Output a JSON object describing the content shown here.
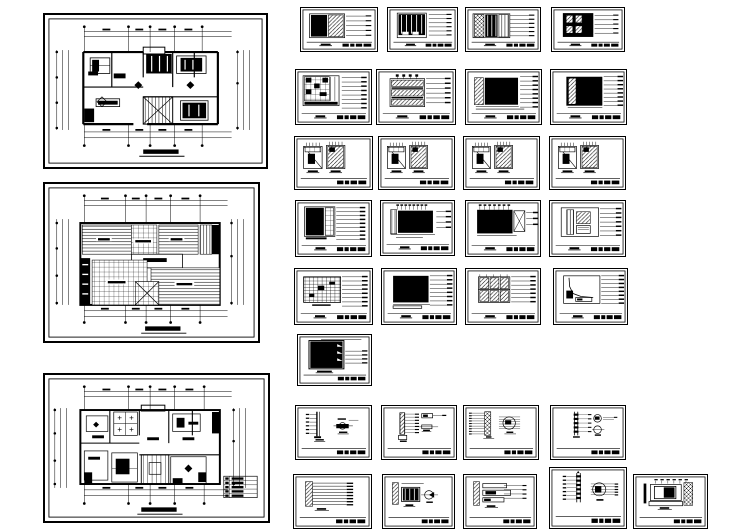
{
  "document": {
    "type": "cad-drawing-set",
    "description": "Architectural interior design CAD drawing set: three residential floor and ceiling plans with dimension grids on the left, and thirty small elevation, section and joinery detail sheets arranged in a grid on the right. Black line work on white paper; all annotation text is at illegible micro scale.",
    "paper_color": "#ffffff",
    "ink_color": "#000000",
    "sheet_count_total": 33
  },
  "plan_sheets": [
    {
      "id": "plan-upper-floor",
      "kind": "furniture layout floor plan with dimension chains and title mark",
      "variant": "plan1",
      "x": 43,
      "y": 13,
      "w": 225,
      "h": 156,
      "has_title_mark": true,
      "has_legend": false
    },
    {
      "id": "ceiling-plan",
      "kind": "reflected ceiling plan with hatched panels, tile grids and title mark",
      "variant": "ceiling",
      "x": 43,
      "y": 182,
      "w": 217,
      "h": 161,
      "has_title_mark": true,
      "has_legend": false
    },
    {
      "id": "plan-lower-floor",
      "kind": "floor plan with legend table and title mark",
      "variant": "plan2",
      "x": 43,
      "y": 373,
      "w": 227,
      "h": 150,
      "has_title_mark": true,
      "has_legend": true
    }
  ],
  "detail_sheets": [
    {
      "id": "detail-01",
      "kind": "wall elevation, dark panel + diagonal hatch",
      "variant": "r1a",
      "x": 300,
      "y": 7,
      "w": 78,
      "h": 45
    },
    {
      "id": "detail-02",
      "kind": "wall elevation, dark panel with mullions",
      "variant": "r1b",
      "x": 387,
      "y": 7,
      "w": 71,
      "h": 45
    },
    {
      "id": "detail-03",
      "kind": "wall elevation, mixed hatch panels",
      "variant": "r1c",
      "x": 465,
      "y": 7,
      "w": 76,
      "h": 45
    },
    {
      "id": "detail-04",
      "kind": "dark elevation with hatched insets",
      "variant": "r1d",
      "x": 551,
      "y": 7,
      "w": 74,
      "h": 45
    },
    {
      "id": "detail-05",
      "kind": "cabinet elevation with grid cells",
      "variant": "r2a",
      "x": 295,
      "y": 69,
      "w": 77,
      "h": 56
    },
    {
      "id": "detail-06",
      "kind": "elevation with three hatched bands",
      "variant": "r2b",
      "x": 376,
      "y": 69,
      "w": 80,
      "h": 56
    },
    {
      "id": "detail-07",
      "kind": "large dark elevation, hatched side strip",
      "variant": "r2c",
      "x": 465,
      "y": 69,
      "w": 77,
      "h": 56
    },
    {
      "id": "detail-08",
      "kind": "large dark elevation, inner hatched strip",
      "variant": "r2d",
      "x": 550,
      "y": 69,
      "w": 77,
      "h": 56
    },
    {
      "id": "detail-09",
      "kind": "pair of wardrobe elevations",
      "variant": "r3",
      "x": 294,
      "y": 136,
      "w": 79,
      "h": 54
    },
    {
      "id": "detail-10",
      "kind": "pair of wardrobe elevations",
      "variant": "r3",
      "x": 378,
      "y": 136,
      "w": 77,
      "h": 54
    },
    {
      "id": "detail-11",
      "kind": "pair of wardrobe elevations",
      "variant": "r3",
      "x": 463,
      "y": 136,
      "w": 77,
      "h": 54
    },
    {
      "id": "detail-12",
      "kind": "pair of wardrobe elevations",
      "variant": "r3",
      "x": 549,
      "y": 136,
      "w": 77,
      "h": 54
    },
    {
      "id": "detail-13",
      "kind": "cabinet elevation with leader stack",
      "variant": "r4a",
      "x": 295,
      "y": 200,
      "w": 77,
      "h": 57
    },
    {
      "id": "detail-14",
      "kind": "wide elevation with top callout flags",
      "variant": "r4b",
      "x": 380,
      "y": 200,
      "w": 75,
      "h": 56
    },
    {
      "id": "detail-15",
      "kind": "wide dark elevation with X-braced panel",
      "variant": "r4c",
      "x": 465,
      "y": 200,
      "w": 76,
      "h": 57
    },
    {
      "id": "detail-16",
      "kind": "elevation with vertical and diagonal hatch",
      "variant": "r4d",
      "x": 549,
      "y": 200,
      "w": 77,
      "h": 57
    },
    {
      "id": "detail-17",
      "kind": "gridded screen elevation",
      "variant": "r5a",
      "x": 294,
      "y": 268,
      "w": 79,
      "h": 57
    },
    {
      "id": "detail-18",
      "kind": "solid dark elevation",
      "variant": "r5b",
      "x": 381,
      "y": 268,
      "w": 76,
      "h": 57
    },
    {
      "id": "detail-19",
      "kind": "elevation with six hatched door cells",
      "variant": "r5c",
      "x": 465,
      "y": 268,
      "w": 76,
      "h": 57
    },
    {
      "id": "detail-20",
      "kind": "elevation with curved profile",
      "variant": "r5d",
      "x": 553,
      "y": 268,
      "w": 75,
      "h": 57
    },
    {
      "id": "detail-21",
      "kind": "single dark elevation with notches",
      "variant": "r6",
      "x": 297,
      "y": 334,
      "w": 75,
      "h": 52
    },
    {
      "id": "detail-22",
      "kind": "vertical section + capsule detail",
      "variant": "r7a",
      "x": 295,
      "y": 405,
      "w": 77,
      "h": 55
    },
    {
      "id": "detail-23",
      "kind": "vertical section + two small details",
      "variant": "r7b",
      "x": 381,
      "y": 405,
      "w": 76,
      "h": 55
    },
    {
      "id": "detail-24",
      "kind": "hatched section + circled detail",
      "variant": "r7c",
      "x": 463,
      "y": 405,
      "w": 76,
      "h": 55
    },
    {
      "id": "detail-25",
      "kind": "section + two circled details",
      "variant": "r7d",
      "x": 550,
      "y": 405,
      "w": 76,
      "h": 55
    },
    {
      "id": "detail-26",
      "kind": "hatched jamb section with leaders",
      "variant": "r8a",
      "x": 293,
      "y": 474,
      "w": 79,
      "h": 55
    },
    {
      "id": "detail-27",
      "kind": "section + circle detail with dark sector",
      "variant": "r8b",
      "x": 382,
      "y": 474,
      "w": 73,
      "h": 55
    },
    {
      "id": "detail-28",
      "kind": "stacked profile sections",
      "variant": "r8c",
      "x": 463,
      "y": 474,
      "w": 74,
      "h": 55
    },
    {
      "id": "detail-29",
      "kind": "tall section + large circled detail",
      "variant": "r8d",
      "x": 549,
      "y": 467,
      "w": 78,
      "h": 62
    },
    {
      "id": "detail-30",
      "kind": "plan detail with nested frames and hatch",
      "variant": "r8e",
      "x": 633,
      "y": 474,
      "w": 75,
      "h": 55
    }
  ]
}
